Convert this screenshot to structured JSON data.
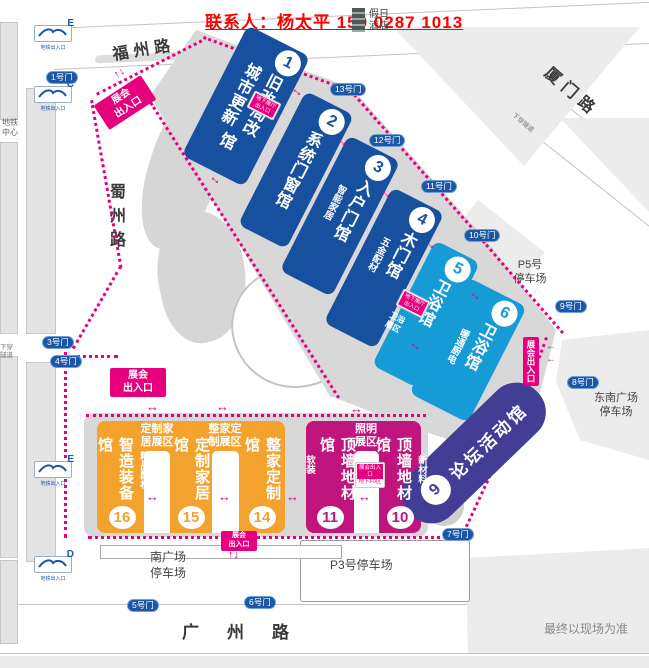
{
  "header": {
    "contact": "联系人：杨太平 159 0287 1013",
    "hotel": "假日酒店"
  },
  "roads": {
    "fuzhou": "福州路",
    "xiamen": "厦门路",
    "shuzhou": "蜀州路",
    "guangzhou": "广州路"
  },
  "metro": {
    "center": "地铁中心",
    "entrance_label": "地铁出入口",
    "letters": [
      "E",
      "C",
      "E",
      "D"
    ]
  },
  "tunnel": "下穿隧道",
  "gates": {
    "g1": "1号门",
    "g3": "3号门",
    "g4": "4号门",
    "g5": "5号门",
    "g6": "6号门",
    "g7": "7号门",
    "g8": "8号门",
    "g9": "9号门",
    "g10": "10号门",
    "g11": "11号门",
    "g12": "12号门",
    "g13": "13号门"
  },
  "halls": {
    "h1": {
      "no": "1",
      "col1": "旧改局改",
      "col2": "城市更新",
      "suffix": "馆"
    },
    "h2": {
      "no": "2",
      "name": "系统门窗馆"
    },
    "h3": {
      "no": "3",
      "name": "入户门馆",
      "side": "智能家居"
    },
    "h4": {
      "no": "4",
      "name": "木门馆",
      "side": "五金配材"
    },
    "h5": {
      "no": "5",
      "name": "卫浴馆"
    },
    "h6": {
      "no": "6",
      "name": "卫浴馆",
      "side": "暖通厨电",
      "corner": "卫浴展区"
    },
    "h9": {
      "no": "9",
      "name": "论坛活动馆"
    },
    "h10": {
      "no": "10",
      "name": "顶墙地材馆",
      "side": "新材料"
    },
    "h11": {
      "no": "11",
      "name": "顶墙地材馆",
      "side": "软装"
    },
    "h14": {
      "no": "14",
      "name": "整家定制馆"
    },
    "h15": {
      "no": "15",
      "name": "定制家居馆"
    },
    "h16": {
      "no": "16",
      "name": "智造装备馆",
      "side": "精品配材"
    }
  },
  "zones": {
    "custom_home": "定制家居展区",
    "whole_home": "整家定制展区",
    "lighting": "照明展区"
  },
  "badges": {
    "expo_l1": "展会",
    "expo_l2": "出入口",
    "expo_v": "展会出入口",
    "basement_l1": "地下展厅",
    "basement_l2": "出入口",
    "basement2_l1": "展会出入口",
    "basement2_l2": "地下F9区"
  },
  "parking": {
    "p5_l1": "P5号",
    "p5_l2": "停车场",
    "p3": "P3号停车场",
    "south_l1": "南广场",
    "south_l2": "停车场",
    "southeast_l1": "东南广场",
    "southeast_l2": "停车场"
  },
  "footer": {
    "note": "最终以现场为准"
  },
  "colors": {
    "navy": "#17509E",
    "light_blue": "#169BD7",
    "indigo": "#423E96",
    "magenta": "#C0157C",
    "orange": "#F2A22D",
    "accent_pink": "#E6007E",
    "contact_red": "#FF0000",
    "gate_blue": "#1B57A5"
  }
}
